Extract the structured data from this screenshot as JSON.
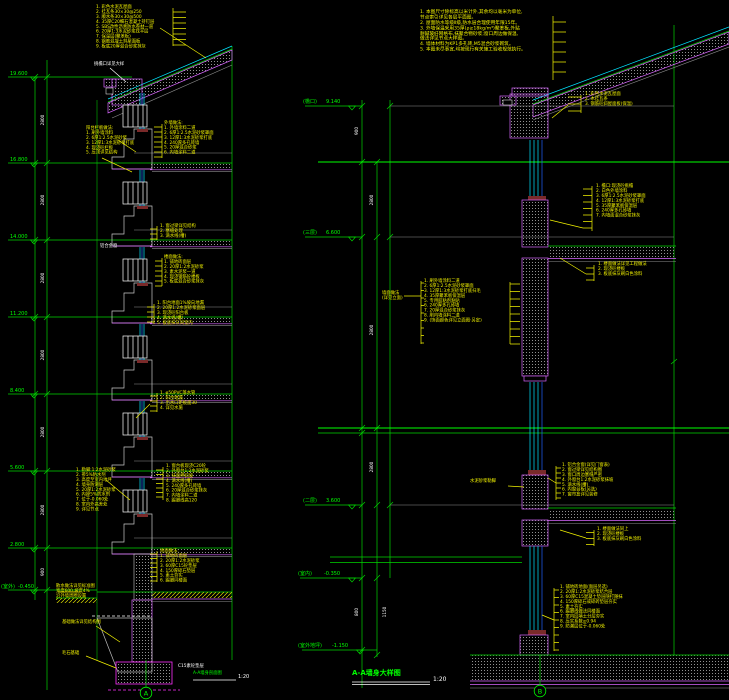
{
  "colors": {
    "background": "#000000",
    "line_green": "#00ff00",
    "line_cyan": "#00e5ff",
    "line_magenta": "#d966ff",
    "annotation_yellow": "#f2f200",
    "dim_white": "#ffffff",
    "hatch_gray": "#909090"
  },
  "left": {
    "title": "A-A墙身剖面图",
    "scale": "1:20",
    "axis": "A",
    "levels": [
      {
        "name": "",
        "value": "19.600"
      },
      {
        "name": "",
        "value": "16.800"
      },
      {
        "name": "",
        "value": "14.000"
      },
      {
        "name": "",
        "value": "11.200"
      },
      {
        "name": "",
        "value": "8.400"
      },
      {
        "name": "",
        "value": "5.600"
      },
      {
        "name": "",
        "value": "2.800"
      },
      {
        "name": "(室外)",
        "value": "-0.450"
      }
    ],
    "dims": [
      "2800",
      "2800",
      "2800",
      "2800",
      "2800",
      "2800",
      "900"
    ],
    "roof_notes": [
      "1. 彩色水泥瓦屋面",
      "2. 挂瓦条30×30@250",
      "3. 顺水条30×30@500",
      "4. 35厚C20细石混凝土持钉层",
      "5. SBS改性沥青防水卷材一道",
      "6. 20厚1:3水泥砂浆找平层",
      "7. 保温层(聚苯板)",
      "8. 钢筋混凝土斜屋面板",
      "9. 板底20厚混合砂浆抹灰"
    ],
    "eave_label": "挑檐口详见大样",
    "balcony_notes": [
      "阳台栏板做法:",
      "1. 刷外墙涂料",
      "2. 6厚1:2.5水泥砂浆",
      "3. 12厚1:3水泥砂浆打底",
      "4. 现浇砼栏板",
      "5. 压顶详见结构"
    ],
    "wall_notes": [
      "外墙做法:",
      "1. 外墙涂料二道",
      "2. 6厚1:2.5水泥砂浆罩面",
      "3. 12厚1:3水泥砂浆打底",
      "4. 240厚多孔砖墙",
      "5. 20厚混合砂浆",
      "6. 内墙涂料二道"
    ],
    "lintel_notes": [
      "1. 窗过梁详见结构",
      "2. 塞缝处理",
      "3. 滴水线(槽)"
    ],
    "window_label": "铝合金窗",
    "floor_notes": [
      "楼面做法:",
      "1. 铺地砖面层",
      "2. 20厚1:2水泥砂浆",
      "3. 素水泥浆一道",
      "4. 现浇钢筋砼楼板",
      "5. 板底混合砂浆抹灰"
    ],
    "slab_notes": [
      "1. 阳台地面1%坡向地漏",
      "2. 20厚1:2水泥砂浆面层",
      "3. 现浇砼阳台板",
      "4. 滴水线(槽)",
      "5. 板底抹灰同室内"
    ],
    "drain_notes": [
      "1. φ50PVC落水管",
      "2. 阳台地漏",
      "3. 出水口距板面30",
      "4. 详见水施"
    ],
    "sill_notes": [
      "1. 窗台板现浇C20砼",
      "2. 外窗台1:2水泥砂浆",
      "3. 抹面押斜坡",
      "4. 滴水线(槽)",
      "5. 240厚多孔砖墙",
      "6. 20厚混合砂浆抹灰",
      "7. 内墙涂料二道",
      "8. 踢脚线高120"
    ],
    "plinth_notes": [
      "1. 勒脚:1:2水泥砂浆",
      "2. 掺5%防水剂",
      "3. 高度至室内地坪",
      "4. 墙身防潮层",
      "5. 20厚1:2水泥砂浆",
      "6. 内掺5%防水剂",
      "7. 位于-0.060处",
      "8. 室内外高差处",
      "9. 详见节点"
    ],
    "ground_notes": [
      "地面做法:",
      "1. 铺地砖面层",
      "2. 20厚1:2水泥砂浆",
      "3. 60厚C15砼垫层",
      "4. 150厚碎石垫层",
      "5. 素土夯实",
      "6. 踢脚同楼面"
    ],
    "apron_notes": [
      "散水做法详见标准图",
      "宽度600,坡度4%",
      "沿外墙周圈设置"
    ],
    "foundation_note": "基础做法详见结构图",
    "footing_label": "毛石基础",
    "cushion_label": "C15素砼垫层"
  },
  "right": {
    "title": "A-A墙身大样图",
    "scale": "1:20",
    "axis": "B",
    "levels": [
      {
        "name": "(檐口)",
        "value": "9.140"
      },
      {
        "name": "(三层)",
        "value": "6.600"
      },
      {
        "name": "(二层)",
        "value": "3.600"
      },
      {
        "name": "(室内)",
        "value": "-0.350"
      },
      {
        "name": "(室外地坪)",
        "value": "-1.150"
      }
    ],
    "dims": [
      "900",
      "2800",
      "2800",
      "2800",
      "800",
      "1150"
    ],
    "general_notes": [
      "1. 本图尺寸除标高以米计外,其余均以毫米为单位,",
      "   节点索引详见各层平面图。",
      "2. 屋面防水等级Ⅱ级,防水层合理使用年限15年。",
      "3. 外墙保温采用35厚(ρ≥18kg/m³)聚苯板,外贴",
      "   耐碱玻纤网格布,抹聚合物砂浆;窗口周边做保温,",
      "   做法详见节点大样图。",
      "4. 墙体材料为KP1多孔砖,M5混合砂浆砌筑。",
      "5. 本图未尽事宜,均按现行有关施工验收规范执行。"
    ],
    "roof_callout": [
      "1. 彩色水泥瓦屋面",
      "2. 木挂瓦条",
      "3. 钢筋砼斜屋面板(保温)"
    ],
    "eave_callout": [
      "1. 檐口:现浇砼挑檐",
      "2. 白色外墙涂料",
      "3. 6厚1:2.5水泥砂浆罩面",
      "4. 12厚1:3水泥砂浆打底",
      "5. 35厚聚苯板保温层",
      "6. 240厚多孔砖墙",
      "7. 内墙面混合砂浆抹灰"
    ],
    "floor_callout_1": [
      "1. 楼面做法详见工程做法",
      "2. 现浇砼楼板",
      "3. 板底抹灰刷白色涂料"
    ],
    "finish_label": [
      "墙面做法",
      "(详见立面)"
    ],
    "finish_callout": [
      "1. 刷外墙涂料二道",
      "2. 6厚1:2.5水泥砂浆罩面",
      "3. 12厚1:3水泥砂浆打底扫毛",
      "4. 35厚聚苯板保温层",
      "5. 专用胶粘剂粘贴",
      "6. 240厚多孔砖墙",
      "7. 20厚混合砂浆抹灰",
      "8. 刷内墙涂料二道",
      "9. (饰面颜色详见立面图·另定)"
    ],
    "plinth_label": "水泥砂浆勒脚",
    "window_callout": [
      "1. 铝合金窗(详见门窗表)",
      "2. 窗过梁详见结构图",
      "3. 窗口周边塞缝严密",
      "4. 外窗台1:2水泥砂浆抹坡",
      "5. 滴水线(槽)",
      "6. 内窗台板(另选)",
      "7. 窗帘盒详见装修"
    ],
    "floor_callout_2": [
      "1. 楼面做法同上",
      "2. 现浇砼楼板",
      "3. 板底抹灰刷白色涂料"
    ],
    "ground_callout": [
      "1. 铺地砖地面(面层另选)",
      "2. 20厚1:2水泥砂浆结合层",
      "3. 60厚C15混凝土垫层随打随抹",
      "4. 150厚碎石或碎砖垫层夯实",
      "5. 素土夯实",
      "6. 踢脚线做法同楼面",
      "7. 室内回填土分层夯实",
      "8. 压实系数≥0.94",
      "9. 防潮层位于-0.060处"
    ]
  }
}
